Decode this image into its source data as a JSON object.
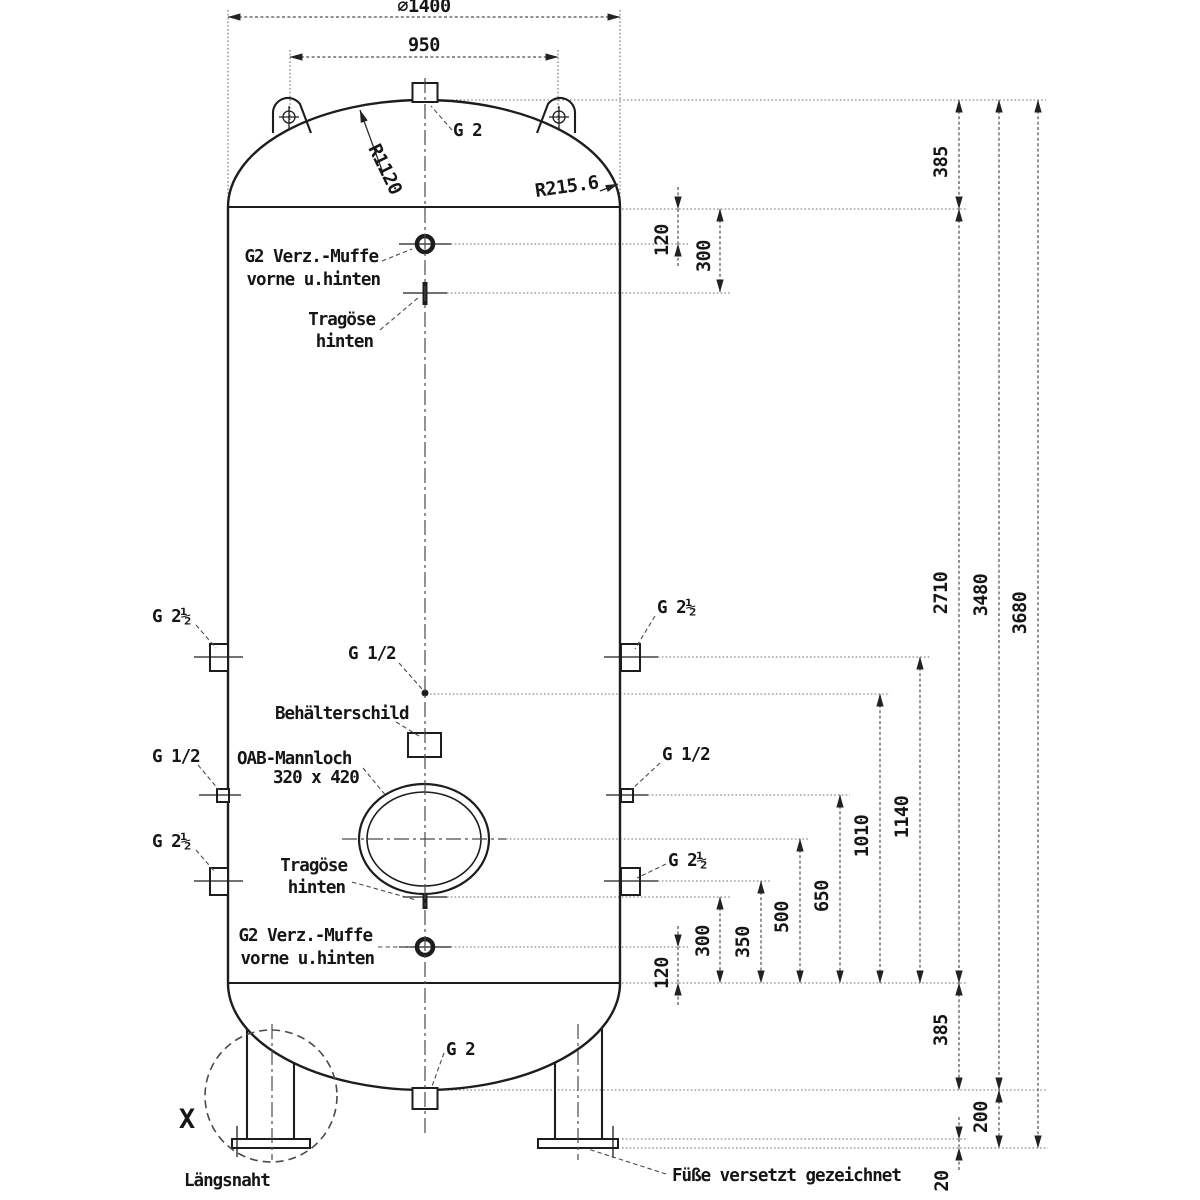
{
  "colors": {
    "ink": "#1d1d1d",
    "paper": "#ffffff"
  },
  "dimensions": {
    "diameter": "⌀1400",
    "lug_spacing": "950",
    "crown_radius": "R1120",
    "knuckle_radius": "R215.6",
    "muffe_top_offset": "120",
    "lug_top_offset": "300",
    "head_top_height": "385",
    "shell_length": "2710",
    "tangent_height": "3480",
    "overall_height": "3680",
    "side_upper_nozzle": "1140",
    "mid_nozzle": "1010",
    "side_g12_nozzle": "650",
    "manhole_height": "500",
    "side_lower_nozzle": "350",
    "lug_bottom_offset": "300",
    "muffe_bottom_offset": "120",
    "head_bottom_height": "385",
    "leg_height": "200",
    "base_plate_thickness": "20"
  },
  "labels": {
    "top_nozzle": "G 2",
    "muffe_top1": "G2 Verz.-Muffe",
    "muffe_top2": "vorne u.hinten",
    "lug_top1": "Tragöse",
    "lug_top2": "hinten",
    "left_upper": "G 2½",
    "left_mid": "G 1/2",
    "left_lower": "G 2½",
    "mid_small": "G 1/2",
    "nameplate": "Behälterschild",
    "manhole1": "OAB-Mannloch",
    "manhole2": "320 x 420",
    "lug_bottom1": "Tragöse",
    "lug_bottom2": "hinten",
    "muffe_bottom1": "G2 Verz.-Muffe",
    "muffe_bottom2": "vorne u.hinten",
    "right_upper": "G 2½",
    "right_mid": "G 1/2",
    "right_lower": "G 2½",
    "bottom_nozzle": "G 2",
    "detail_mark": "X",
    "seam": "Längsnaht",
    "feet_note": "Füße versetzt gezeichnet"
  }
}
